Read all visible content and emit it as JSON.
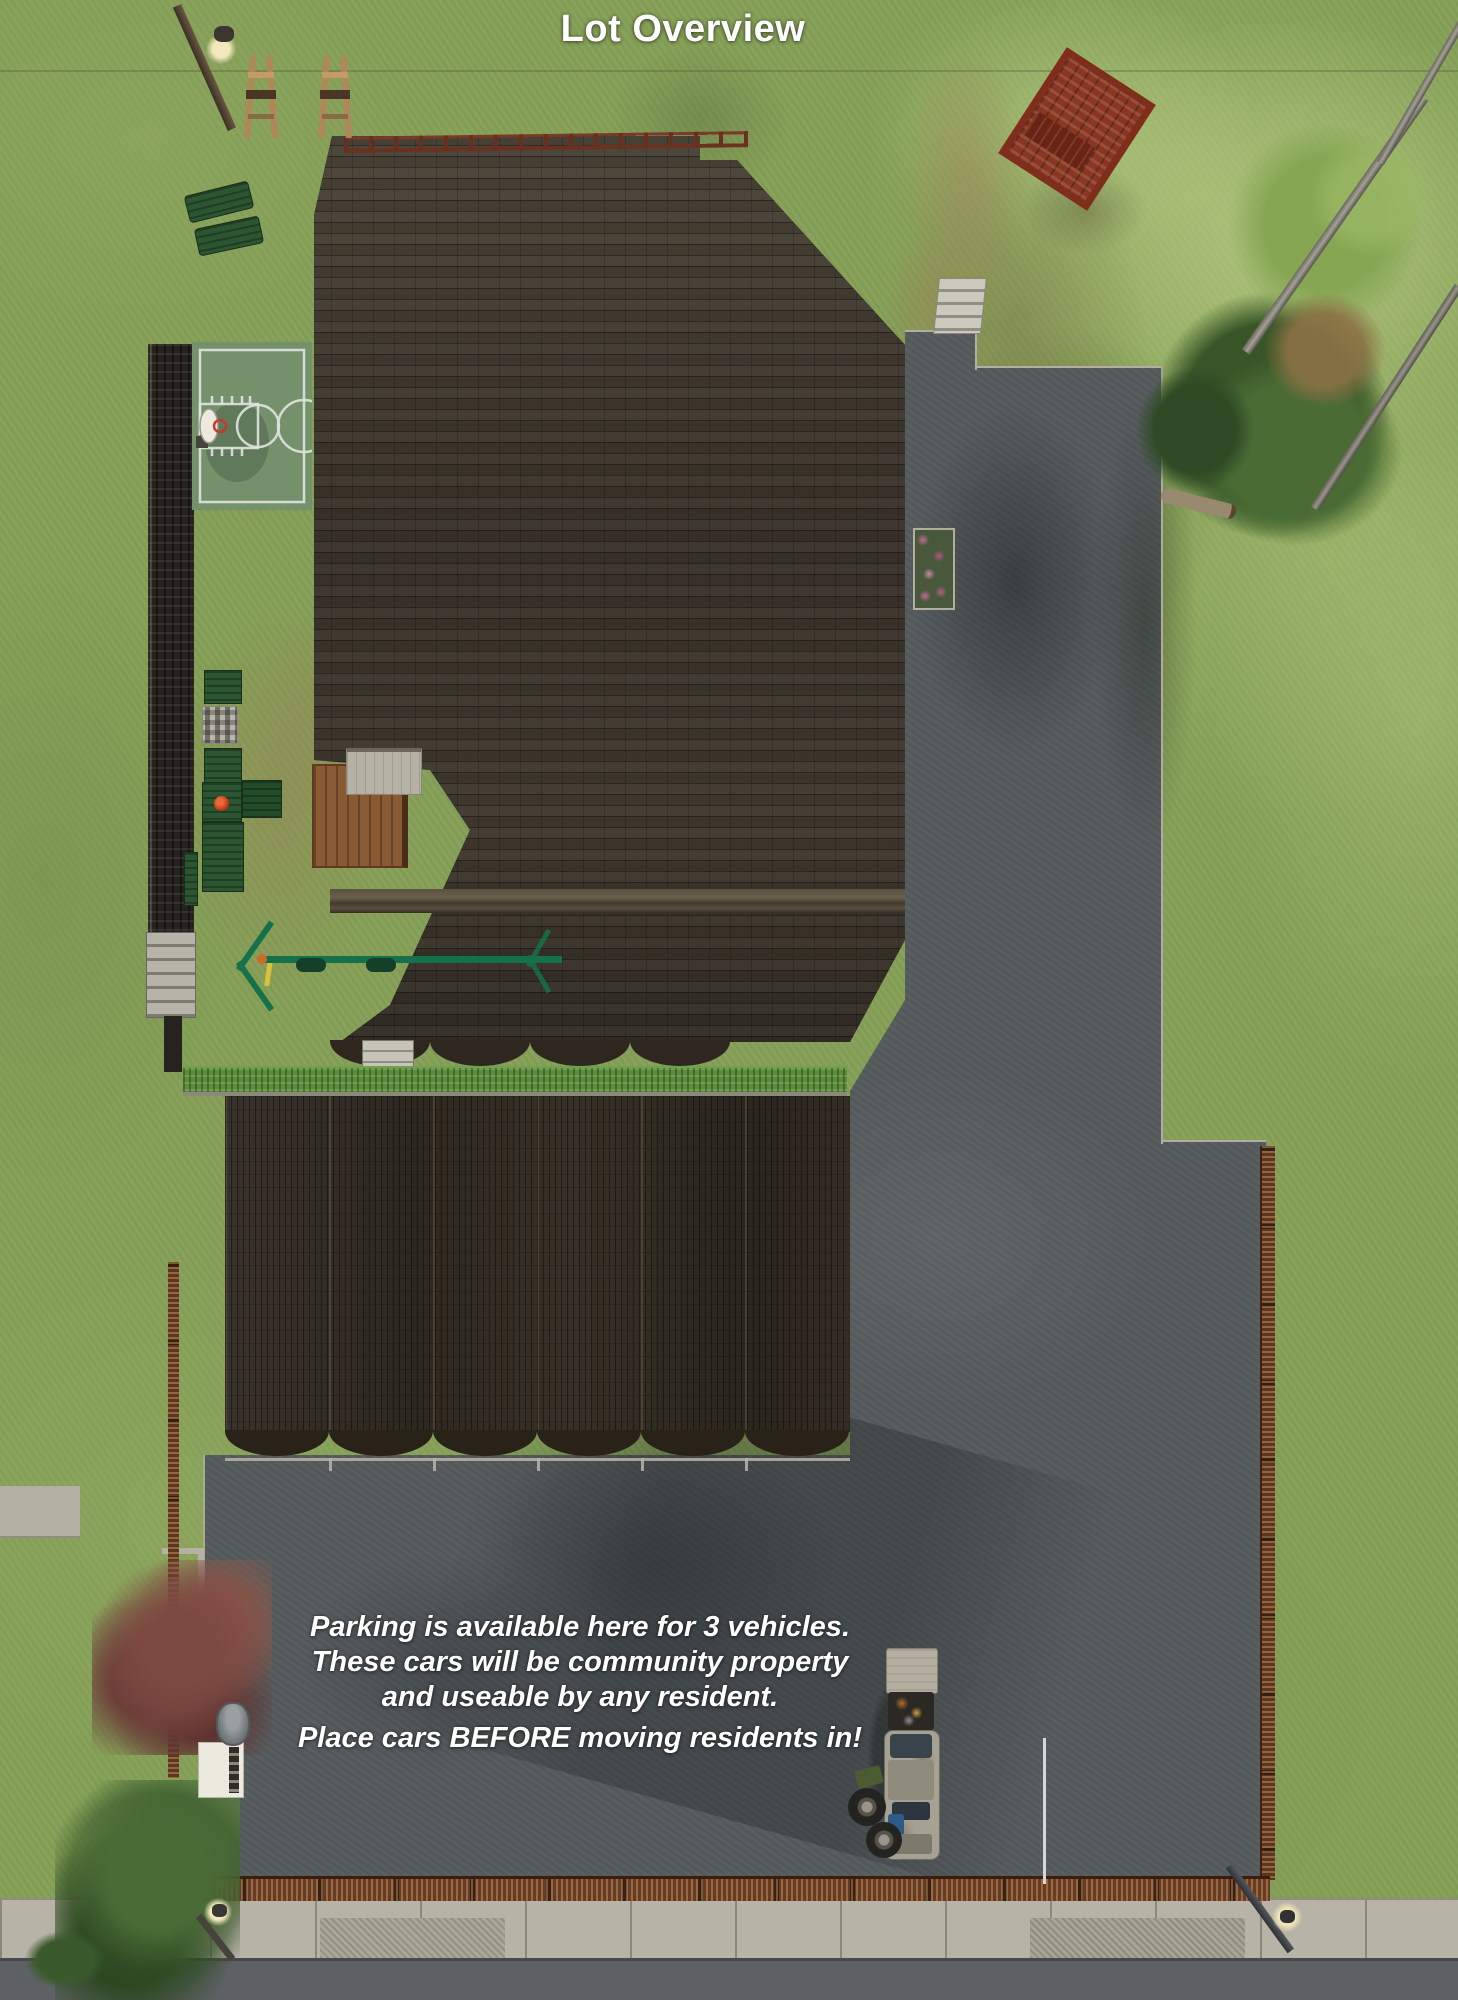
{
  "title": "Lot Overview",
  "caption": {
    "line1": "Parking is available here for 3 vehicles.",
    "line2": "These cars will be community property",
    "line3": "and useable by any resident.",
    "line4": "Place cars BEFORE moving residents in!"
  },
  "colors": {
    "grass": "#85A057",
    "roof_shingle": "#37312A",
    "asphalt": "#565C5D",
    "court_surface": "#75916C",
    "hedge": "#5C8C3A",
    "fence_wood": "#6B3A22",
    "annotation_text": "#FFFFFF"
  },
  "scene": {
    "objects": [
      "street-lamp",
      "easel",
      "lounge-chair",
      "basketball-court",
      "basketball-hoop",
      "stone-wall",
      "stone-stairs",
      "park-bench",
      "chess-table",
      "picnic-table",
      "barbecue-grill",
      "swing-set",
      "wooden-deck",
      "porch-roof",
      "apartment-roof",
      "roof-railing",
      "garage-roof",
      "hedge",
      "porch-swing",
      "concrete-steps",
      "flower-bed",
      "planting-bed",
      "shrub",
      "pine-trees",
      "dead-tree-trunk",
      "fallen-log",
      "maple-tree",
      "junk-car",
      "spare-tires",
      "wood-fence",
      "parking-lot",
      "driveway",
      "sidewalk",
      "road",
      "trash-can",
      "dumpster",
      "sign-pole"
    ]
  }
}
